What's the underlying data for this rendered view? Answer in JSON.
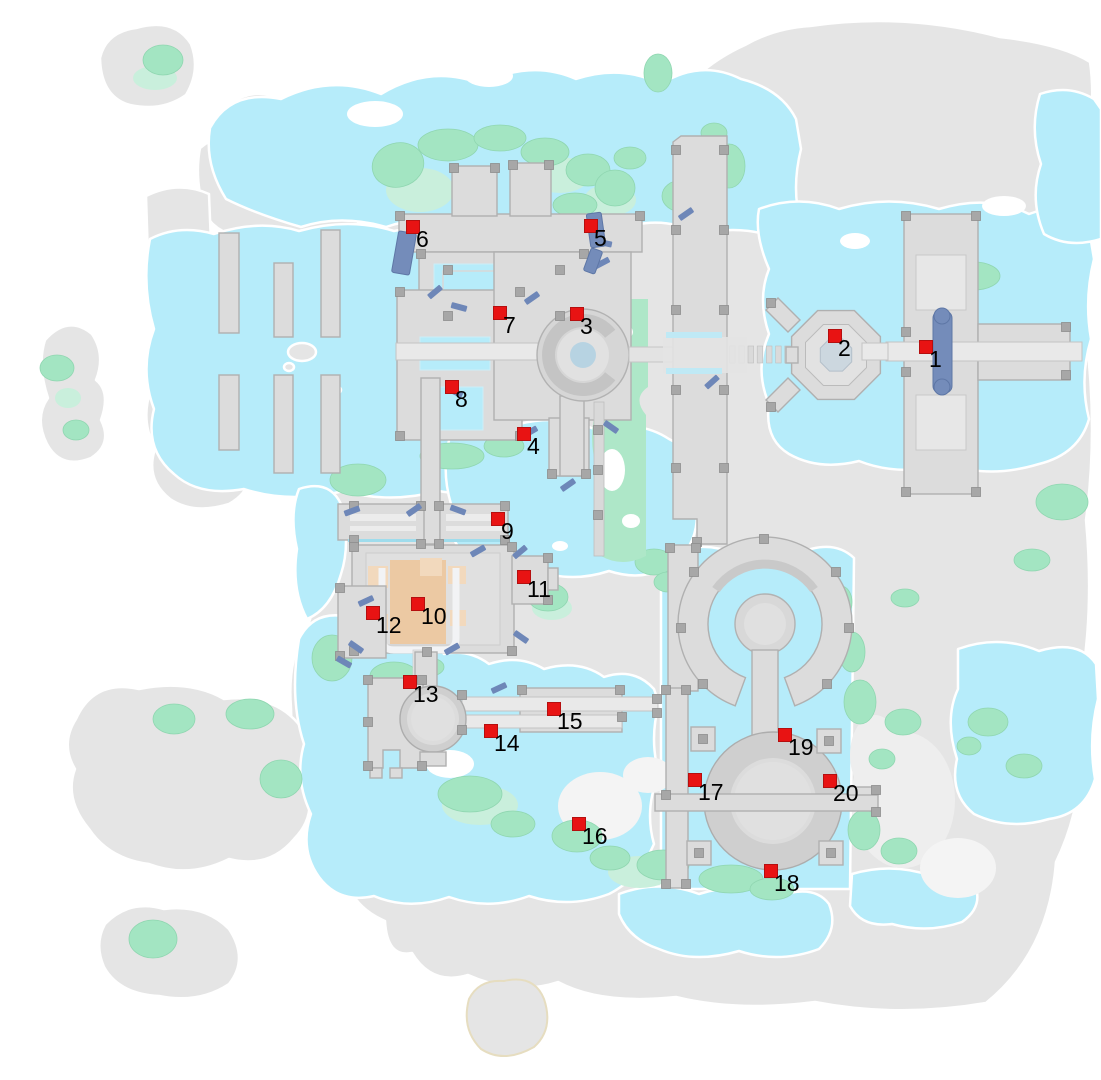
{
  "map": {
    "type": "game-world-map",
    "colors": {
      "background": "#ffffff",
      "water": "#b6ecfa",
      "land": "#e5e5e5",
      "green": "#a3e5c2",
      "green_pale": "#c9efdc",
      "structure": "#dcdcdc",
      "pool": "#748cba",
      "bench": "#6e87b8",
      "orange": "#ecc9a3",
      "plaza": "#b7d3e2",
      "marker": "#e81313",
      "label": "#000000"
    },
    "markers": [
      {
        "id": "1",
        "x": 926,
        "y": 347
      },
      {
        "id": "2",
        "x": 835,
        "y": 336
      },
      {
        "id": "3",
        "x": 577,
        "y": 314
      },
      {
        "id": "4",
        "x": 524,
        "y": 434
      },
      {
        "id": "5",
        "x": 591,
        "y": 226
      },
      {
        "id": "6",
        "x": 413,
        "y": 227
      },
      {
        "id": "7",
        "x": 500,
        "y": 313
      },
      {
        "id": "8",
        "x": 452,
        "y": 387
      },
      {
        "id": "9",
        "x": 498,
        "y": 519
      },
      {
        "id": "10",
        "x": 418,
        "y": 604
      },
      {
        "id": "11",
        "x": 524,
        "y": 577
      },
      {
        "id": "12",
        "x": 373,
        "y": 613
      },
      {
        "id": "13",
        "x": 410,
        "y": 682
      },
      {
        "id": "14",
        "x": 491,
        "y": 731
      },
      {
        "id": "15",
        "x": 554,
        "y": 709
      },
      {
        "id": "16",
        "x": 579,
        "y": 824
      },
      {
        "id": "17",
        "x": 695,
        "y": 780
      },
      {
        "id": "18",
        "x": 771,
        "y": 871
      },
      {
        "id": "19",
        "x": 785,
        "y": 735
      },
      {
        "id": "20",
        "x": 830,
        "y": 781
      }
    ]
  }
}
